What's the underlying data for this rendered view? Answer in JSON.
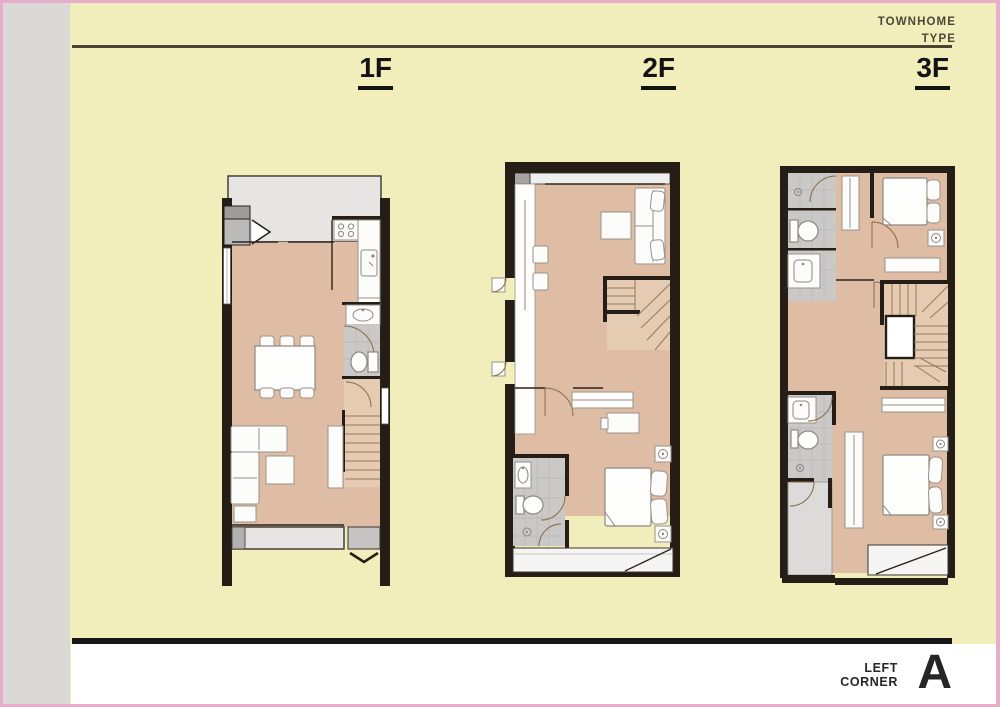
{
  "header": {
    "title_line1": "TOWNHOME",
    "title_line2": "TYPE"
  },
  "floors": [
    {
      "id": "1f",
      "label": "1F"
    },
    {
      "id": "2f",
      "label": "2F"
    },
    {
      "id": "3f",
      "label": "3F"
    }
  ],
  "footer": {
    "corner_line1": "LEFT",
    "corner_line2": "CORNER",
    "unit_type": "A"
  },
  "icons": [
    "stove-icon",
    "kitchen-sink-icon",
    "washbasin-icon",
    "toilet-icon",
    "shower-drain-icon",
    "entrance-arrow-icon",
    "door-swing-arc"
  ],
  "colors": {
    "background": "#f2eebc",
    "margin_band": "#dad9d5",
    "frame_pink": "#e7aecb",
    "wall": "#251e16",
    "floor_tan": "#dfbda4",
    "stair_tan": "#e5cbb1",
    "wet_gray": "#cac9c7",
    "terrace_gray": "#e6e5e3",
    "rule_dark": "#4a4433",
    "header_text": "#4b4737",
    "label_black": "#131313",
    "footer_text": "#262626",
    "furniture_white": "#fcfcfb"
  }
}
